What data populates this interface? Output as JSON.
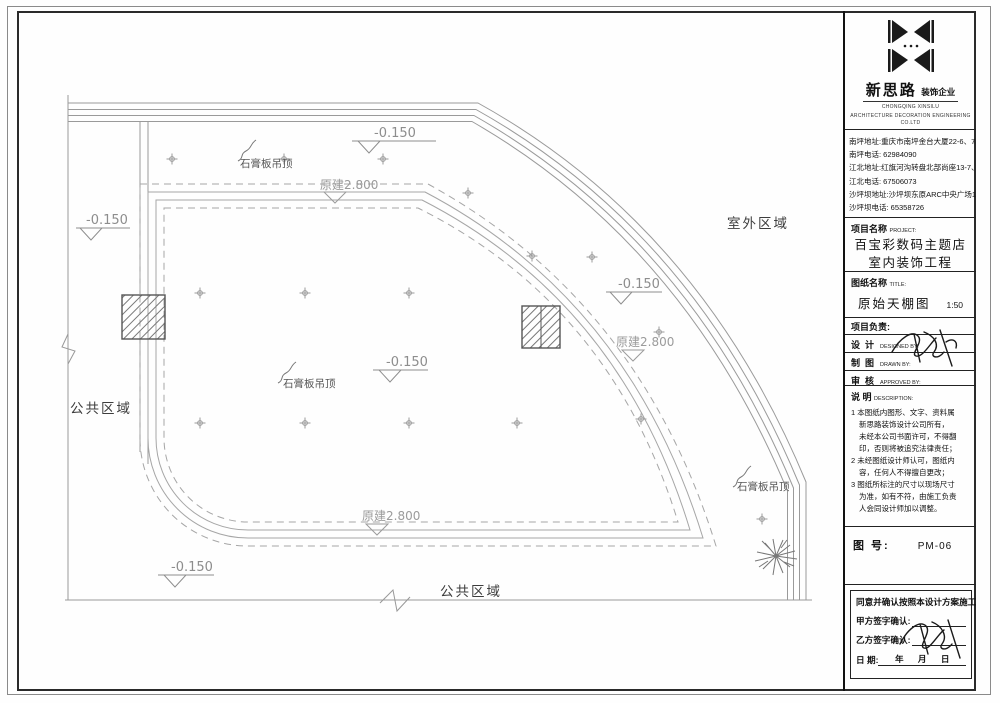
{
  "company": {
    "name": "新思路",
    "type": "装饰企业",
    "en_line1": "CHONGQING XINSILU",
    "en_line2": "ARCHITECTURE DECORATION ENGINEERING CO.LTD"
  },
  "contacts": {
    "lines": [
      "南坪地址:重庆市南坪金台大厦22-6、7、9、10",
      "南坪电话: 62984090",
      "江北地址:红旗河沟转盘北部尚座13-7、8、9",
      "江北电话: 67506073",
      "沙坪坝地址:沙坪坝东原ARC中央广场1-10-3",
      "沙坪坝电话: 65358726"
    ]
  },
  "project": {
    "label": "项目名称",
    "label_en": "PROJECT:",
    "name_line1": "百宝彩数码主题店",
    "name_line2": "室内装饰工程"
  },
  "sheet": {
    "label": "图纸名称",
    "label_en": "TITLE:",
    "name": "原始天棚图",
    "scale": "1:50"
  },
  "team": {
    "header": "项目负责:",
    "design_zh": "设  计",
    "design_en": "DESIGNED BY:",
    "draft_zh": "制  图",
    "draft_en": "DRAWN BY:",
    "review_zh": "审  核",
    "review_en": "APPROVED BY:"
  },
  "notes": {
    "label_zh": "说  明",
    "label_en": "DESCRIPTION:",
    "lines": [
      "1 本图纸内图形、文字、资料属",
      "新思路装饰设计公司所有，",
      "未经本公司书面许可，不得翻",
      "印，否则将被追究法律责任；",
      "2 未经图纸设计师认可，图纸内",
      "容，任何人不得擅自更改；",
      "3 图纸所标注的尺寸以现场尺寸",
      "为准，如有不符，由施工负责",
      "人会同设计师加以调整。"
    ]
  },
  "sheet_no": {
    "label": "图 号:",
    "value": "PM-06"
  },
  "confirm": {
    "statement": "同意并确认按照本设计方案施工。",
    "party_a": "甲方签字确认:",
    "party_b": "乙方签字确认:",
    "date_label": "日      期:",
    "date_value": "年      月      日"
  },
  "plan": {
    "labels": {
      "gypsum_ceiling": "石膏板吊顶",
      "outdoor_area": "室外区域",
      "public_area": "公共区域",
      "elevation": "-0.150",
      "orig_ceiling": "原建2.800"
    }
  }
}
